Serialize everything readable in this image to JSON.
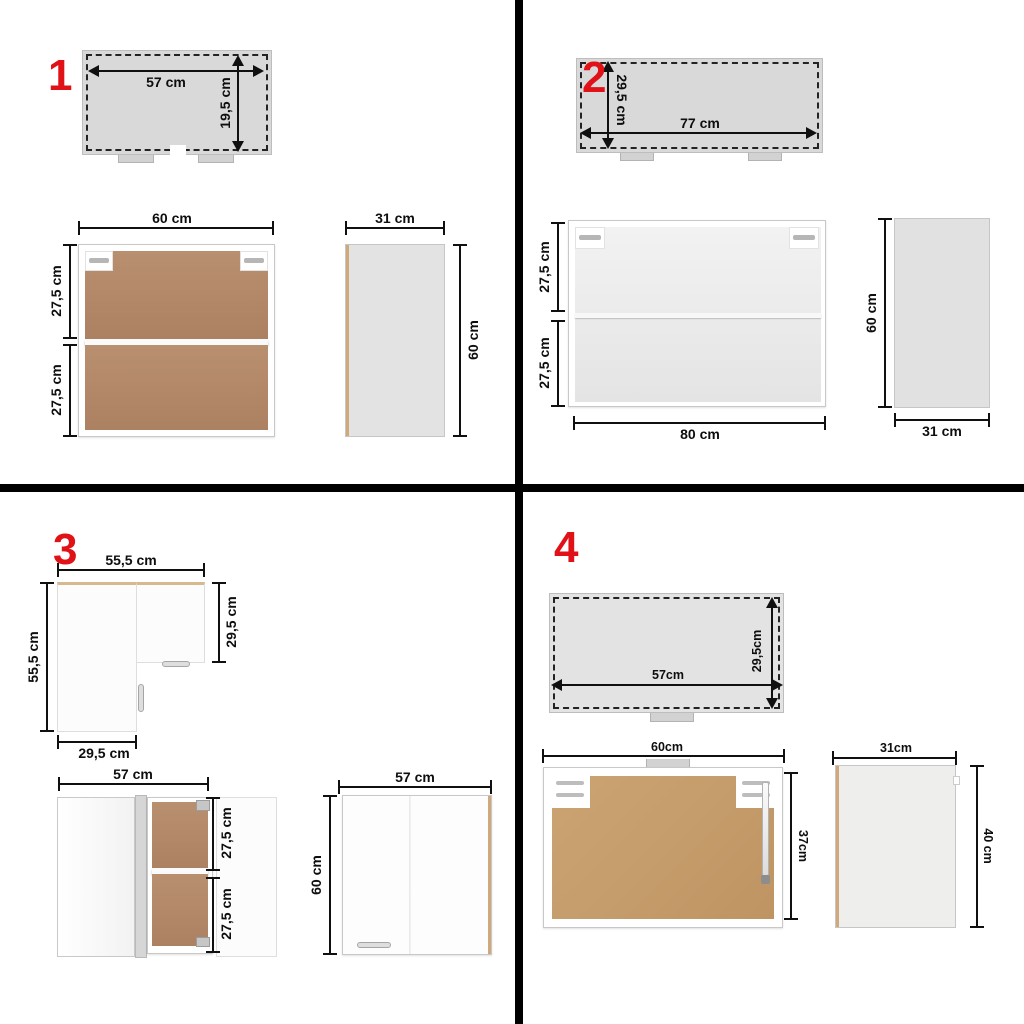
{
  "colors": {
    "accent_red": "#e01117",
    "divider_black": "#000000",
    "dimension_line": "#101010",
    "top_view_fill": "#d9d9d9",
    "wood_brown": "#b4886a",
    "kraft_brown": "#c79e6d",
    "glass_fill": "#ededed",
    "side_panel_fill": "#e3e3e3",
    "edge_tan": "#cfa97c"
  },
  "panels": [
    {
      "number": "1",
      "top_view": {
        "width": "57 cm",
        "depth": "19,5 cm"
      },
      "front_view": {
        "width": "60 cm",
        "upper": "27,5 cm",
        "lower": "27,5 cm"
      },
      "side_view": {
        "width": "31 cm",
        "height": "60 cm"
      }
    },
    {
      "number": "2",
      "top_view": {
        "depth": "29,5 cm",
        "width": "77 cm"
      },
      "front_view": {
        "upper": "27,5 cm",
        "lower": "27,5 cm",
        "width": "80 cm"
      },
      "side_view": {
        "height": "60 cm",
        "width": "31 cm"
      }
    },
    {
      "number": "3",
      "corner_top_view": {
        "top_width": "55,5 cm",
        "left_depth": "55,5 cm",
        "right_depth": "29,5 cm",
        "bottom_width": "29,5 cm"
      },
      "open_view": {
        "width": "57 cm",
        "upper": "27,5 cm",
        "lower": "27,5 cm"
      },
      "front_view": {
        "width": "57 cm",
        "height": "60 cm"
      }
    },
    {
      "number": "4",
      "top_view": {
        "width": "57cm",
        "depth": "29,5cm"
      },
      "front_view": {
        "width": "60cm",
        "height": "37cm"
      },
      "side_view": {
        "width": "31cm",
        "height": "40 cm"
      }
    }
  ]
}
